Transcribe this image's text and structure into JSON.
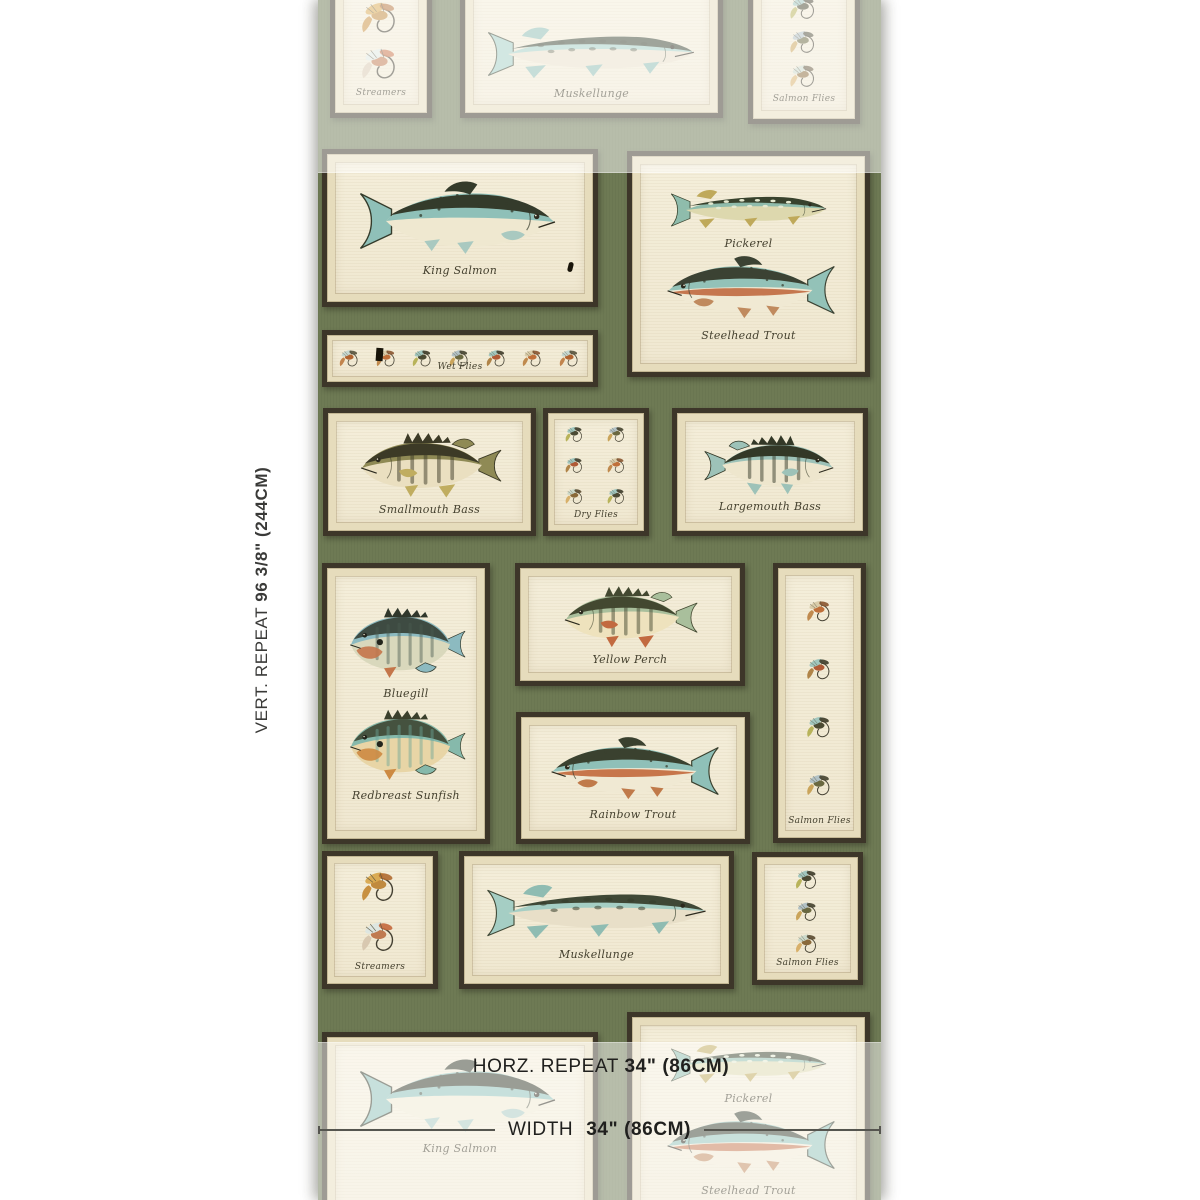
{
  "annotations": {
    "vert_repeat_label": "VERT. REPEAT",
    "vert_repeat_value": "96 3/8\" (244CM)",
    "horz_repeat_label": "HORZ. REPEAT",
    "horz_repeat_value": "34\" (86CM)",
    "width_label": "WIDTH",
    "width_value": "34\" (86CM)"
  },
  "panels": {
    "king_salmon": "King Salmon",
    "pickerel": "Pickerel",
    "steelhead_trout": "Steelhead Trout",
    "wet_flies": "Wet Flies",
    "smallmouth_bass": "Smallmouth Bass",
    "dry_flies": "Dry Flies",
    "largemouth_bass": "Largemouth Bass",
    "bluegill": "Bluegill",
    "redbreast_sunfish": "Redbreast Sunfish",
    "yellow_perch": "Yellow Perch",
    "rainbow_trout": "Rainbow Trout",
    "salmon_flies": "Salmon Flies",
    "streamers": "Streamers",
    "muskellunge": "Muskellunge"
  },
  "colors": {
    "page_background": "#ffffff",
    "wallpaper_ground": "#6e7a54",
    "frame_brown": "#3d3629",
    "mat_tan": "#e6dcbc",
    "panel_cream": "#f3edd8",
    "fish_teal": "#8fc0b8",
    "fish_dark_olive": "#343b2b",
    "fish_orange": "#c2693c",
    "fade_overlay": "rgba(255,255,255,0.5)",
    "annotation_text": "#20201e"
  }
}
